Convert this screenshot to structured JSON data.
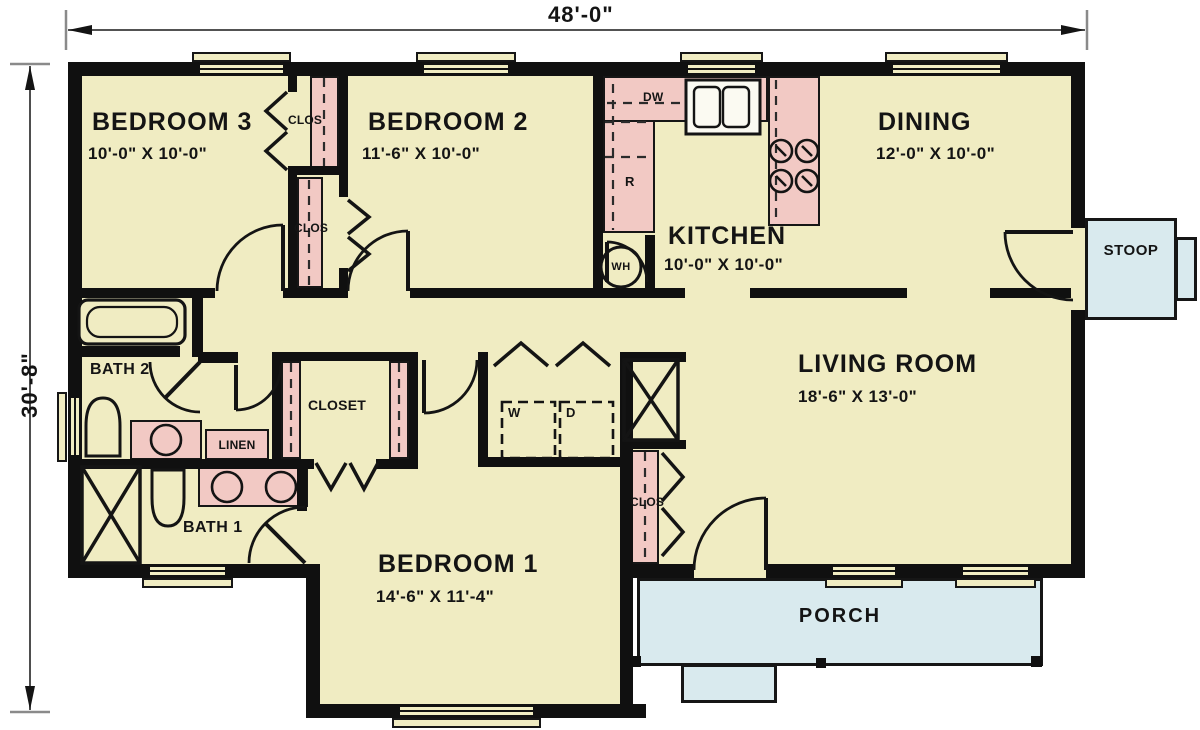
{
  "plan": {
    "type": "single-story house floor plan",
    "dimensions": {
      "overall_width": "48'-0\"",
      "overall_depth": "30'-8\""
    },
    "rooms": {
      "bedroom3": {
        "name": "BEDROOM 3",
        "dims": "10'-0\" X 10'-0\""
      },
      "bedroom2": {
        "name": "BEDROOM 2",
        "dims": "11'-6\" X 10'-0\""
      },
      "dining": {
        "name": "DINING",
        "dims": "12'-0\" X 10'-0\""
      },
      "kitchen": {
        "name": "KITCHEN",
        "dims": "10'-0\" X 10'-0\""
      },
      "living": {
        "name": "LIVING ROOM",
        "dims": "18'-6\" X 13'-0\""
      },
      "bedroom1": {
        "name": "BEDROOM 1",
        "dims": "14'-6\" X 11'-4\""
      },
      "bath1": {
        "name": "BATH 1"
      },
      "bath2": {
        "name": "BATH 2"
      }
    },
    "spaces": {
      "stoop": "STOOP",
      "porch": "PORCH",
      "walkin_closet": "CLOSET",
      "linen": "LINEN",
      "bedroom3_clos": "CLOS",
      "bedroom2_clos": "CLOS",
      "living_clos": "CLOS"
    },
    "fixtures": {
      "dishwasher": "DW",
      "range": "R",
      "water_heater": "WH",
      "washer": "W",
      "dryer": "D"
    },
    "colors": {
      "floor": "#f0ecc2",
      "casework": "#f2c9c4",
      "outdoor": "#d9eaee",
      "wall": "#101010",
      "background": "#ffffff"
    }
  }
}
